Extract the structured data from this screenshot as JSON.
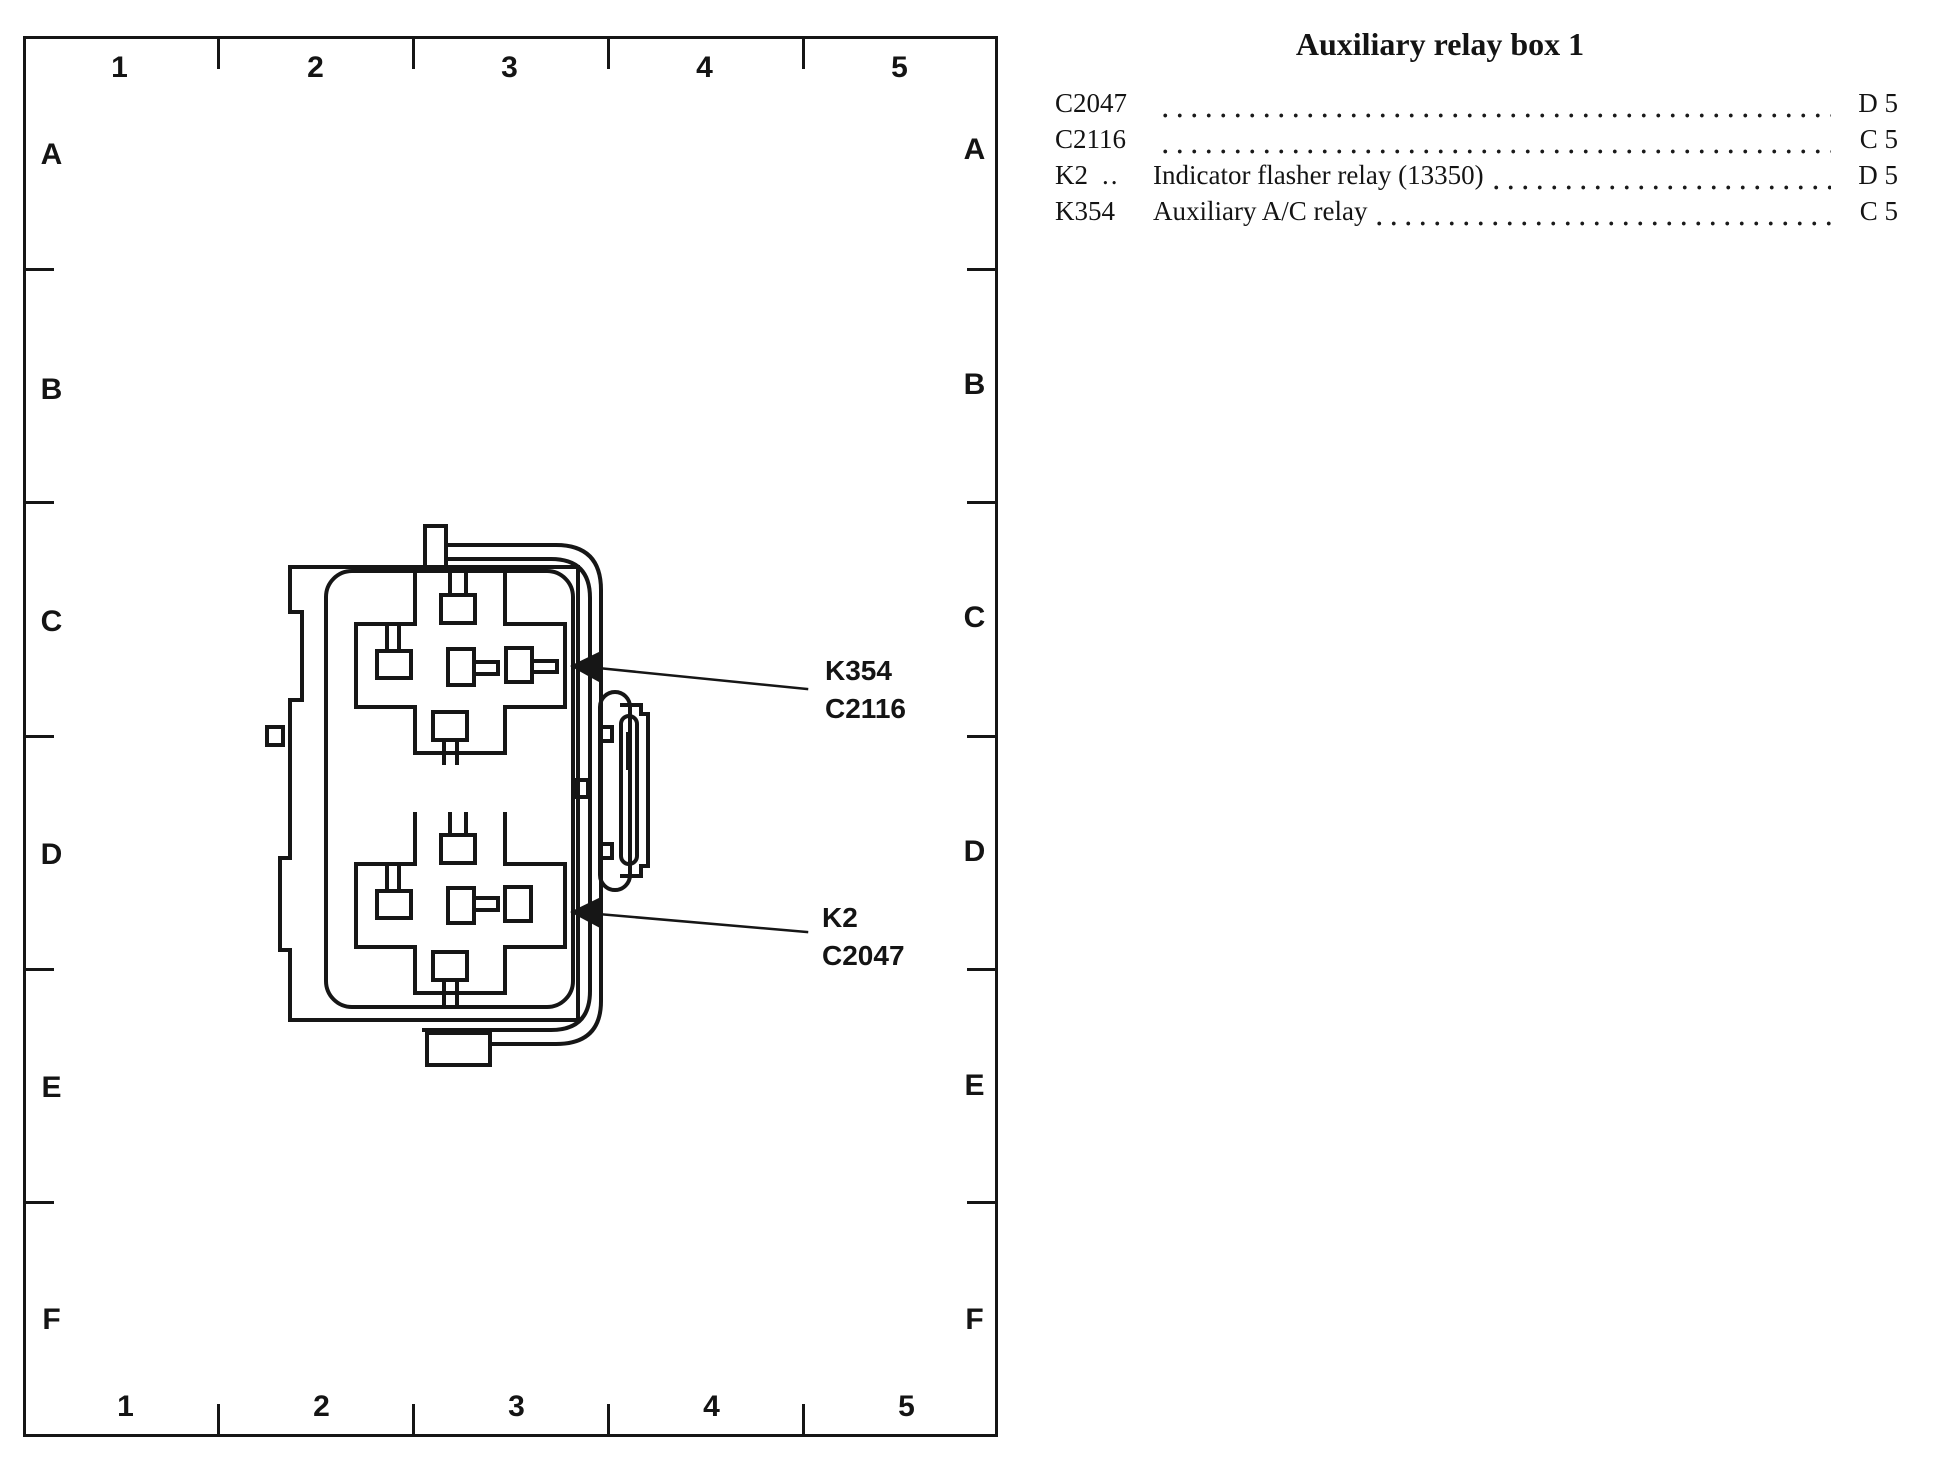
{
  "page": {
    "background": "#ffffff",
    "ink": "#161616"
  },
  "grid": {
    "columns": [
      "1",
      "2",
      "3",
      "4",
      "5"
    ],
    "rows": [
      "A",
      "B",
      "C",
      "D",
      "E",
      "F"
    ]
  },
  "diagram": {
    "callouts": [
      {
        "line1": "K354",
        "line2": "C2116"
      },
      {
        "line1": "K2",
        "line2": "C2047"
      }
    ]
  },
  "legend": {
    "title": "Auxiliary relay box 1",
    "rows": [
      {
        "label": "C2047",
        "filler": "",
        "desc": "",
        "ref": "D 5"
      },
      {
        "label": "C2116",
        "filler": "",
        "desc": "",
        "ref": "C 5"
      },
      {
        "label": "K2",
        "filler": "..",
        "desc": "Indicator flasher relay (13350)",
        "ref": "D 5"
      },
      {
        "label": "K354",
        "filler": "",
        "desc": "Auxiliary A/C relay",
        "ref": "C 5"
      }
    ]
  }
}
